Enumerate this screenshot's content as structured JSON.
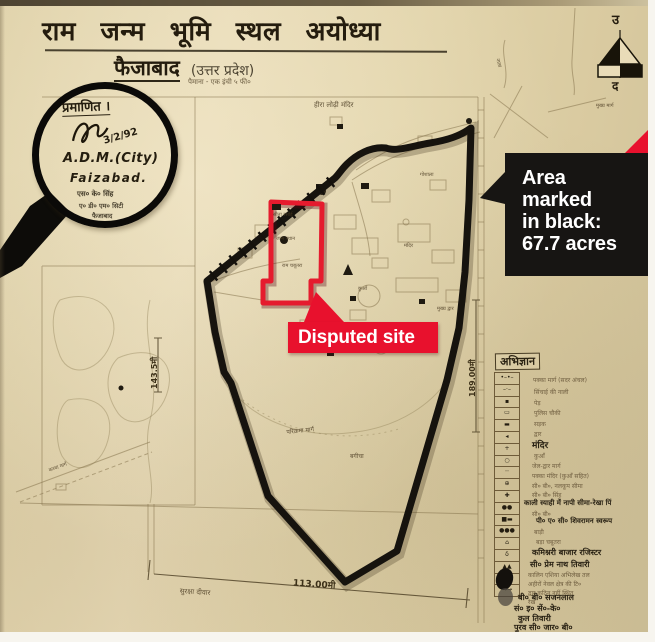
{
  "title": {
    "main": "राम जन्म भूमि स्थल अयोध्या",
    "city": "फैजाबाद",
    "state": "(उत्तर प्रदेश)",
    "scale": "पैमाना - एक इंची ५ फी०"
  },
  "compass": {
    "north": "उ",
    "south": "द"
  },
  "stamp": {
    "certified": "प्रमाणित ।",
    "date": "3/2/92",
    "authority": "A.D.M.(City)",
    "place": "Faizabad.",
    "seal1": "एस० के० सिंह",
    "seal2": "ए० डी० एम० सिटी",
    "seal3": "फैजाबाद"
  },
  "callouts": {
    "area": {
      "line1": "Area",
      "line2": "marked",
      "line3": "in black:",
      "line4": "67.7 acres"
    },
    "disputed": {
      "text": "Disputed site"
    }
  },
  "dimensions": {
    "bottom": "113.00मी",
    "right": "189.00मी",
    "left": "143.5मी"
  },
  "colors": {
    "accent_red": "#e8112d",
    "label_black": "#171513",
    "paper": "#e2d4ab",
    "ink": "#17140f"
  },
  "map_labels": [
    {
      "text": "हीरा लोढ़ी मंदिर",
      "x": 314,
      "y": 101,
      "s": 7,
      "r": 0
    },
    {
      "text": "गोशाला",
      "x": 420,
      "y": 172,
      "s": 5,
      "r": 0
    },
    {
      "text": "सीता रसोई",
      "x": 273,
      "y": 212,
      "s": 5,
      "r": 0
    },
    {
      "text": "जन्म स्थान",
      "x": 276,
      "y": 236,
      "s": 5,
      "r": 0
    },
    {
      "text": "राम चबूतरा",
      "x": 282,
      "y": 263,
      "s": 5,
      "r": 0
    },
    {
      "text": "कुआँ",
      "x": 358,
      "y": 286,
      "s": 5,
      "r": 0
    },
    {
      "text": "मंदिर",
      "x": 404,
      "y": 243,
      "s": 5,
      "r": 0
    },
    {
      "text": "मुख्य द्वार",
      "x": 437,
      "y": 306,
      "s": 5,
      "r": 0
    },
    {
      "text": "बगीचा",
      "x": 350,
      "y": 452,
      "s": 6,
      "r": 0
    },
    {
      "text": "परिक्रमा मार्ग",
      "x": 286,
      "y": 428,
      "s": 6,
      "r": -6
    },
    {
      "text": "कच्चा मार्ग",
      "x": 48,
      "y": 468,
      "s": 5,
      "r": -20
    },
    {
      "text": "सुरक्षा दीवार",
      "x": 180,
      "y": 587,
      "s": 7,
      "r": 4
    },
    {
      "text": "मुख्य मार्ग",
      "x": 596,
      "y": 103,
      "s": 5,
      "r": 0
    },
    {
      "text": "नाला",
      "x": 500,
      "y": 58,
      "s": 5,
      "r": 75
    }
  ],
  "legend": {
    "title": "अभिज्ञान",
    "symbols": [
      "•–•–",
      "–·–",
      "▪",
      "▭",
      "▬",
      "◂",
      "+",
      "○",
      "┈",
      "⊕",
      "✚",
      "●●",
      "■▬",
      "●●●",
      "⌂",
      "δ",
      "▲▲",
      "●▬",
      "→→"
    ],
    "lines": [
      {
        "text": "पक्का मार्ग (सदर अंचल)",
        "x": 533,
        "y": 376,
        "s": 6,
        "b": 0
      },
      {
        "text": "सिंचाई की नाली",
        "x": 534,
        "y": 388,
        "s": 6,
        "b": 0
      },
      {
        "text": "पेड़",
        "x": 534,
        "y": 399,
        "s": 6,
        "b": 0
      },
      {
        "text": "पुलिस चौकी",
        "x": 534,
        "y": 409,
        "s": 6,
        "b": 0
      },
      {
        "text": "सड़क",
        "x": 534,
        "y": 420,
        "s": 6,
        "b": 0
      },
      {
        "text": "द्वार",
        "x": 534,
        "y": 430,
        "s": 6,
        "b": 0
      },
      {
        "text": "मंदिर",
        "x": 532,
        "y": 438,
        "s": 9,
        "b": 1
      },
      {
        "text": "कुआँ",
        "x": 534,
        "y": 452,
        "s": 6,
        "b": 0
      },
      {
        "text": "जेल-द्वार मार्ग",
        "x": 532,
        "y": 462,
        "s": 6,
        "b": 0
      },
      {
        "text": "पक्का मंदिर (कुआँ सहित)",
        "x": 532,
        "y": 472,
        "s": 6,
        "b": 0
      },
      {
        "text": "सी० बी०, नलकूप सीमा",
        "x": 532,
        "y": 482,
        "s": 6,
        "b": 0
      },
      {
        "text": "सी० बी० सिंह",
        "x": 532,
        "y": 491,
        "s": 6,
        "b": 0
      },
      {
        "text": "काली स्याही में नापी सीमा-रेखा पिं",
        "x": 524,
        "y": 499,
        "s": 7,
        "b": 1
      },
      {
        "text": "सी० बी०",
        "x": 532,
        "y": 510,
        "s": 6,
        "b": 0
      },
      {
        "text": "पी० ए० सी० शिवरामन स्वरूप",
        "x": 536,
        "y": 517,
        "s": 7,
        "b": 1
      },
      {
        "text": "बाड़ी",
        "x": 534,
        "y": 528,
        "s": 6,
        "b": 0
      },
      {
        "text": "बड़ा चबूतरा",
        "x": 536,
        "y": 538,
        "s": 6,
        "b": 0
      },
      {
        "text": "कमिश्नरी बाजार रजिस्टर",
        "x": 532,
        "y": 547,
        "s": 8,
        "b": 1
      },
      {
        "text": "सी० प्रेम नाथ तिवारी",
        "x": 530,
        "y": 559,
        "s": 8,
        "b": 1
      },
      {
        "text": "कालिन एशिया अभिलेख तल",
        "x": 528,
        "y": 571,
        "s": 6,
        "b": 0
      },
      {
        "text": "अहीरों नेवल क्षेत्र की टि०",
        "x": 528,
        "y": 580,
        "s": 6,
        "b": 0
      },
      {
        "text": "द्वार कठिन नहीं स्थित",
        "x": 528,
        "y": 589,
        "s": 6,
        "b": 0
      },
      {
        "text": "रेख",
        "x": 528,
        "y": 598,
        "s": 6,
        "b": 0
      },
      {
        "text": "बी० बी० सजनलाल",
        "x": 518,
        "y": 592,
        "s": 8,
        "b": 1
      },
      {
        "text": "सं० इ० सें०-के०",
        "x": 514,
        "y": 603,
        "s": 8,
        "b": 1
      },
      {
        "text": "कुल तिवारी",
        "x": 518,
        "y": 613,
        "s": 8,
        "b": 1
      },
      {
        "text": "पुरव सी० जार० बी०",
        "x": 514,
        "y": 622,
        "s": 8,
        "b": 1
      }
    ]
  }
}
